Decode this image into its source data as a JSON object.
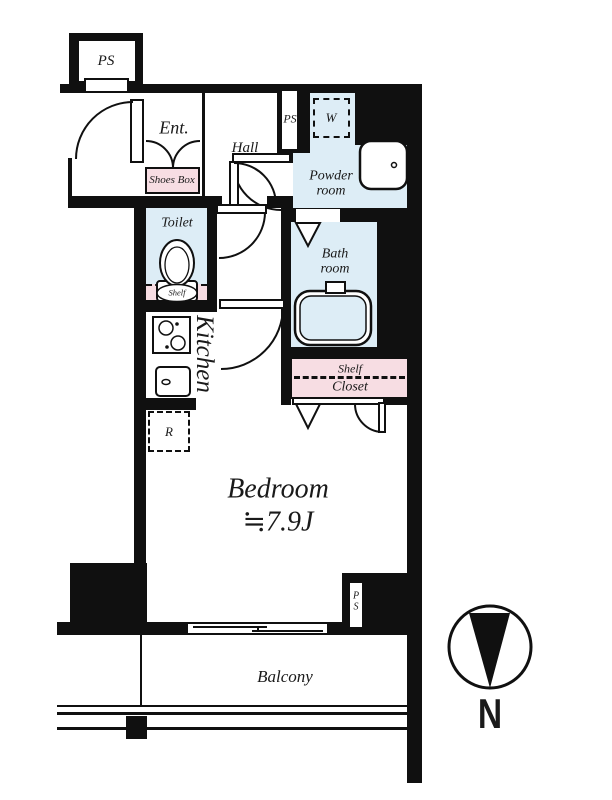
{
  "labels": {
    "ps_top": "PS",
    "entrance": "Ent.",
    "hall": "Hall",
    "ps_middle": "PS",
    "washing_machine": "W",
    "powder_line1": "Powder",
    "powder_line2": "room",
    "shoes_box": "Shoes Box",
    "toilet": "Toilet",
    "toilet_shelf": "Shelf",
    "bath_line1": "Bath",
    "bath_line2": "room",
    "kitchen": "Kitchen",
    "refrigerator": "R",
    "closet_shelf": "Shelf",
    "closet": "Closet",
    "bedroom": "Bedroom",
    "bedroom_size": "≒7.9J",
    "ps_bottom_line1": "P",
    "ps_bottom_line2": "S",
    "balcony": "Balcony",
    "compass_north": "N"
  },
  "colors": {
    "wall": "#101010",
    "wet_area_fill": "#ddedf6",
    "storage_fill": "#f7dde3",
    "line": "#1a1a1a"
  }
}
